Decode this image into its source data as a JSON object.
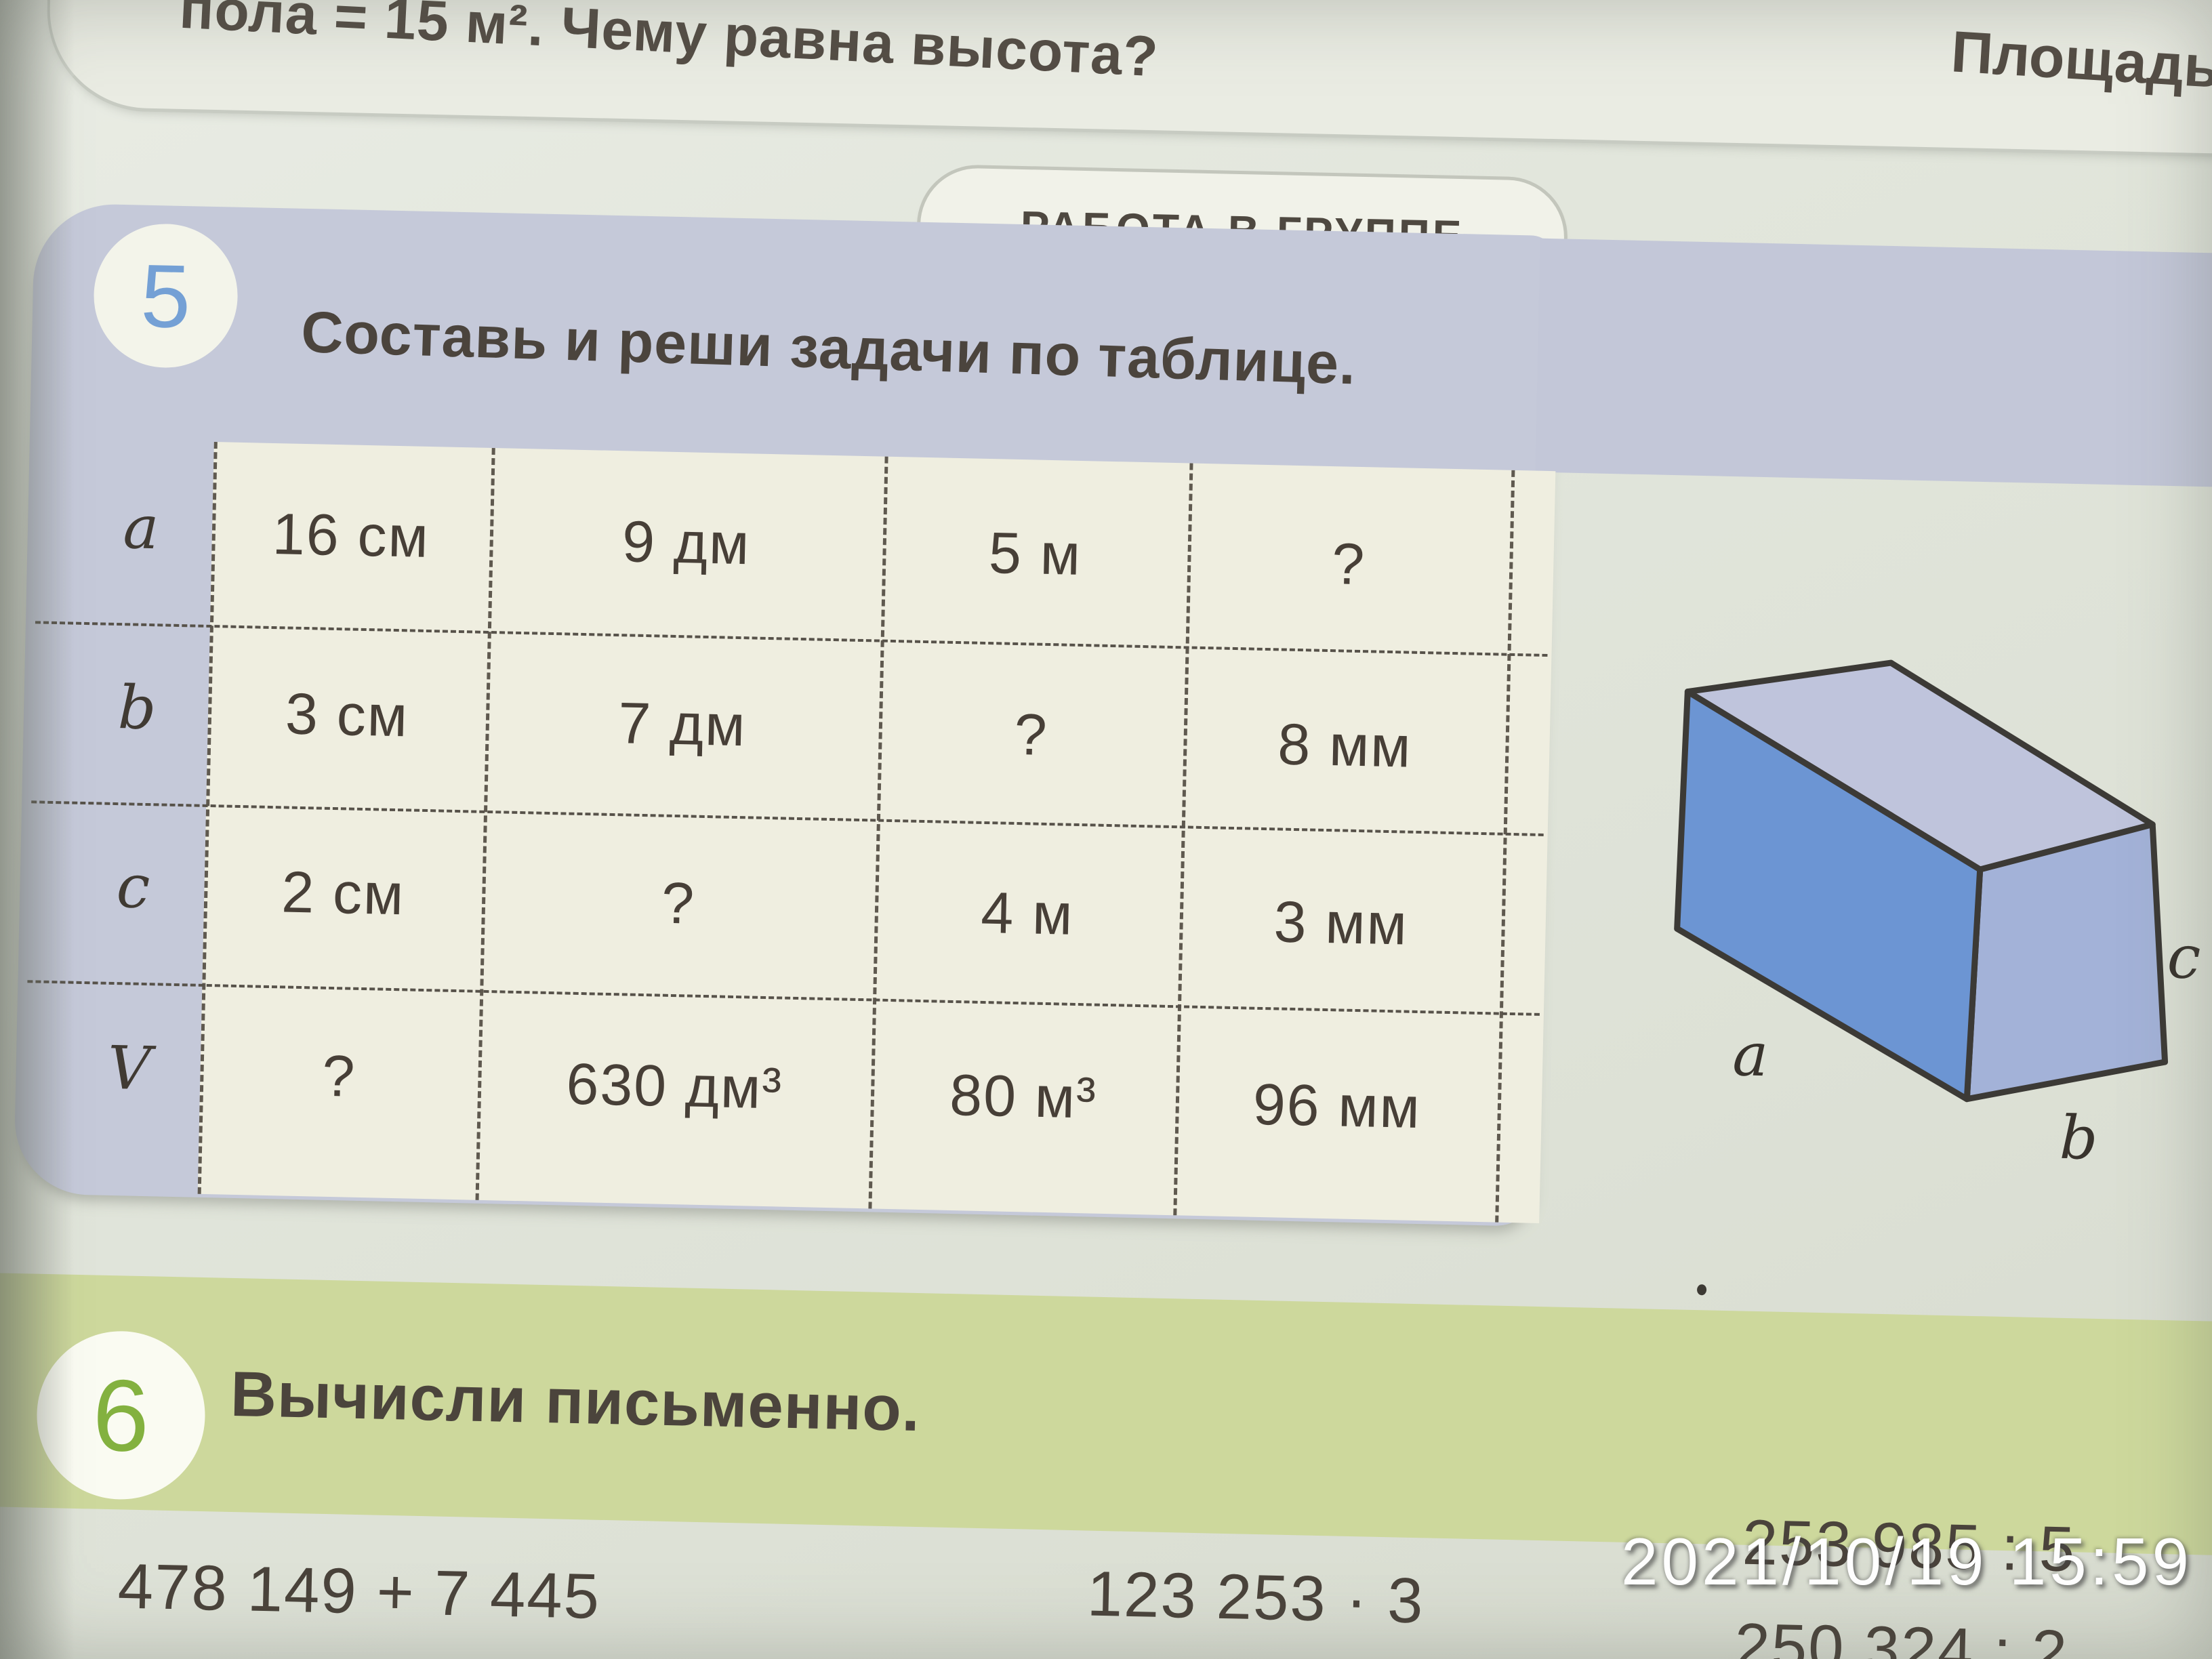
{
  "photo_overlay": {
    "timestamp": "2021/10/19 15:59"
  },
  "previous_task": {
    "text_fragment": "пола = 15 м². Чему равна высота?",
    "next_page_fragment": "Площадь"
  },
  "group_badge": {
    "label": "РАБОТА В ГРУППЕ"
  },
  "task5": {
    "number": "5",
    "title": "Составь и реши задачи по таблице.",
    "table": {
      "rows": [
        {
          "label": "a",
          "cells": [
            "16 см",
            "9 дм",
            "5 м",
            "?"
          ]
        },
        {
          "label": "b",
          "cells": [
            "3 см",
            "7 дм",
            "?",
            "8 мм"
          ]
        },
        {
          "label": "c",
          "cells": [
            "2 см",
            "?",
            "4 м",
            "3 мм"
          ]
        },
        {
          "label": "V",
          "cells": [
            "?",
            "630 дм³",
            "80 м³",
            "96 мм"
          ]
        }
      ]
    },
    "figure": {
      "type": "cuboid",
      "edge_labels": {
        "length": "a",
        "width": "b",
        "height": "c"
      },
      "colors": {
        "front": "#6c95d3",
        "top": "#bfc4dc",
        "side": "#a3b2d8",
        "outline": "#3c3a36"
      }
    }
  },
  "task6": {
    "number": "6",
    "title": "Вычисли письменно.",
    "expressions": [
      [
        "478 149 + 7 445",
        "95 035 − 49 145"
      ],
      [
        "123 253 · 3",
        "39 487 · 6"
      ],
      [
        "253 985 : 5",
        "250 324 : 2"
      ]
    ]
  },
  "colors": {
    "task5_panel": "#c5c9d9",
    "table_cells": "#efeee0",
    "task6_panel": "#cdd89c",
    "task5_number": "#74a0d5",
    "task6_number": "#83b13f",
    "text": "#4a433c"
  }
}
